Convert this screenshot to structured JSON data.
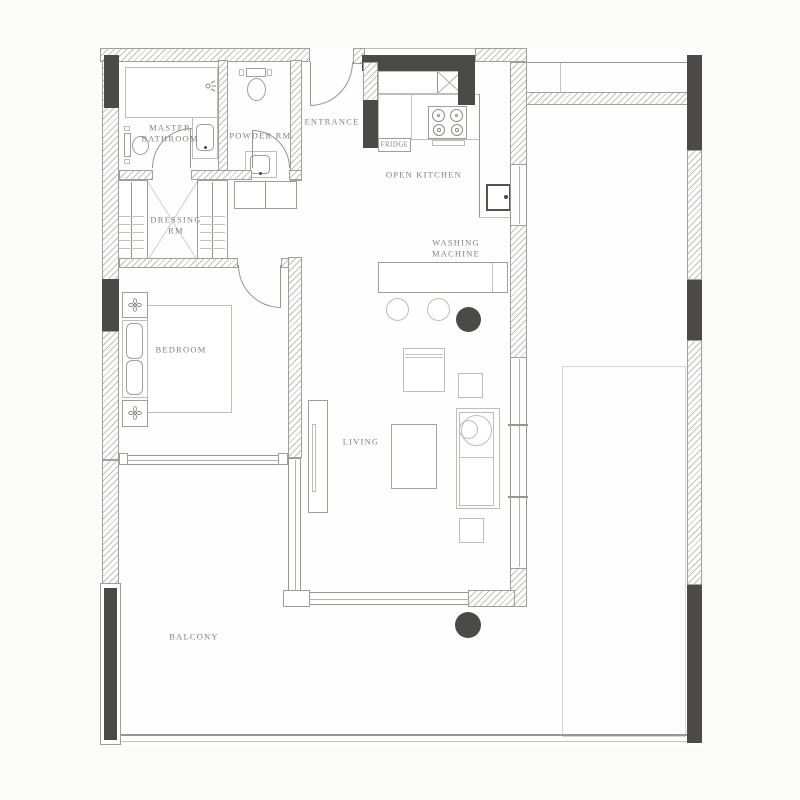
{
  "title": "Apartment floor plan",
  "colors": {
    "wall_dark": "#4b4a46",
    "line": "#9a968f",
    "label_text": "#83807a",
    "background": "#fbfbfa",
    "floor": "#fefefe"
  },
  "labels": {
    "master_bathroom": [
      "MASTER",
      "BATHROOM"
    ],
    "powder_room": "POWDER RM.",
    "entrance": "ENTRANCE",
    "fridge": "FRIDGE",
    "open_kitchen": "OPEN KITCHEN",
    "washing_machine": [
      "WASHING",
      "MACHINE"
    ],
    "dressing_room": [
      "DRESSING",
      "RM"
    ],
    "bedroom": "BEDROOM",
    "living": "LIVING",
    "balcony": "BALCONY"
  },
  "icons": [
    "plant-icon",
    "shower-head-icon",
    "toilet-icon",
    "sink-icon",
    "stove-burner-icon",
    "cabinet-cross-icon",
    "wardrobe-rail-icon",
    "door-swing-arc",
    "stool-icon",
    "washing-machine-icon"
  ]
}
